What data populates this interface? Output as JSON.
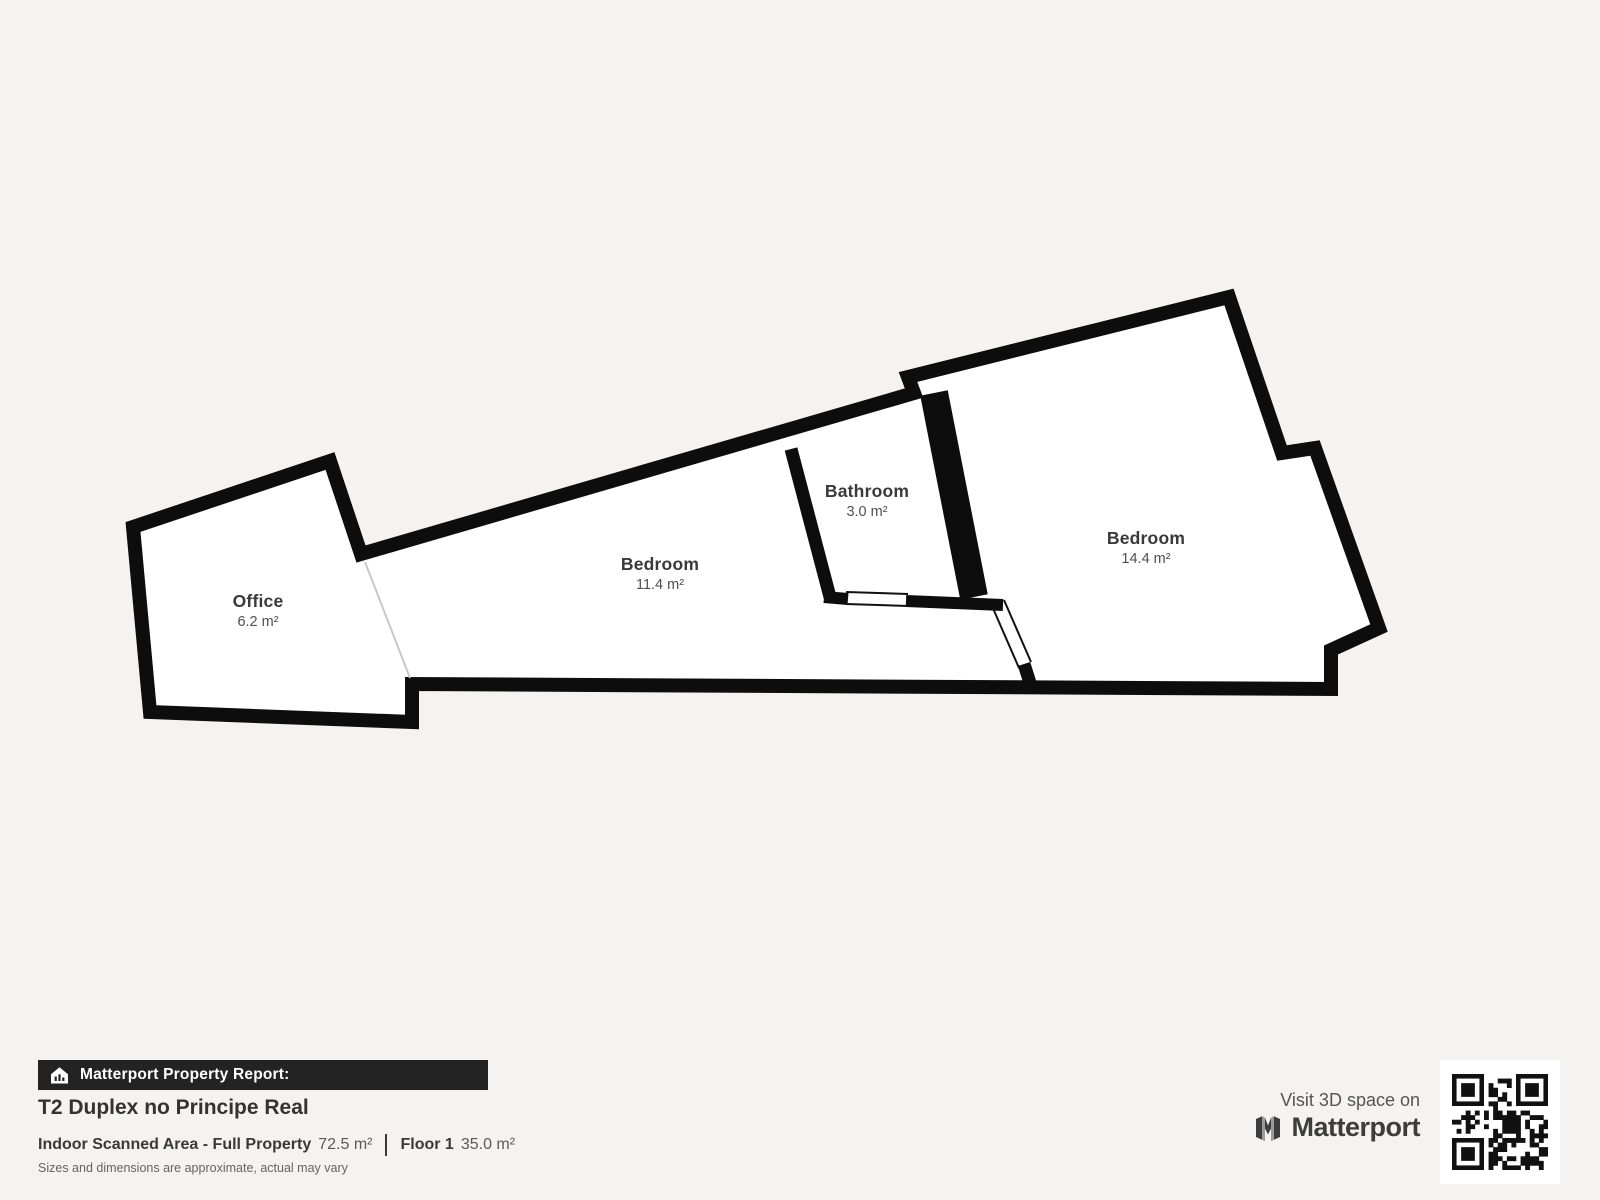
{
  "floorplan": {
    "rooms": [
      {
        "name": "Office",
        "area": "6.2 m²"
      },
      {
        "name": "Bedroom",
        "area": "11.4 m²"
      },
      {
        "name": "Bathroom",
        "area": "3.0 m²"
      },
      {
        "name": "Bedroom",
        "area": "14.4 m²"
      }
    ]
  },
  "footer": {
    "report_label": "Matterport Property Report:",
    "property_title": "T2 Duplex no Principe Real",
    "scanned_area_label": "Indoor Scanned Area - Full Property",
    "scanned_area_value": "72.5 m²",
    "floor_label": "Floor 1",
    "floor_value": "35.0 m²",
    "disclaimer": "Sizes and dimensions are approximate, actual may vary"
  },
  "promo": {
    "visit_text": "Visit 3D space on",
    "brand": "Matterport"
  },
  "colors": {
    "background": "#f4f3f1",
    "wall": "#0d0d0d",
    "floor": "#ffffff",
    "bar_background": "#232323",
    "text_dark": "#3a3a3a",
    "text_muted": "#5a5a5a"
  }
}
